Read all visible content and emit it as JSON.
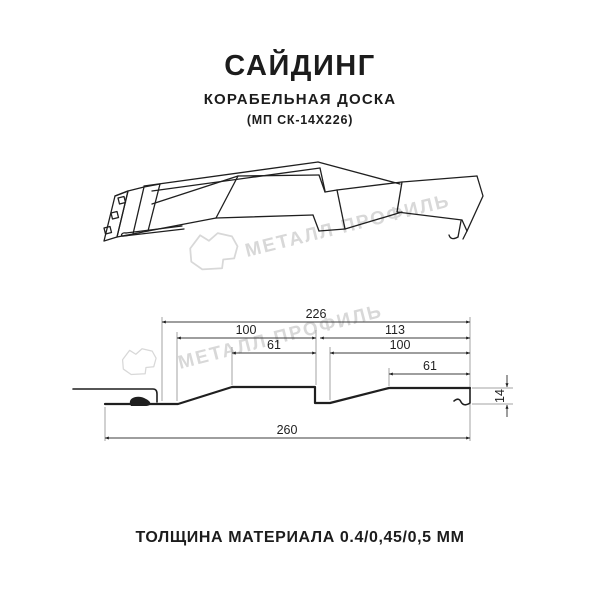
{
  "header": {
    "title": "САЙДИНГ",
    "subtitle": "КОРАБЕЛЬНАЯ ДОСКА",
    "model": "(МП СК-14Х226)"
  },
  "watermark": {
    "text": "МЕТАЛЛ ПРОФИЛЬ"
  },
  "drawing": {
    "module_width": "226",
    "panel1_width": "100",
    "panel1_flat": "61",
    "panel2_module": "113",
    "panel2_width": "100",
    "panel2_flat": "61",
    "total_width": "260",
    "profile_height": "14"
  },
  "footer": {
    "thickness_label": "ТОЛЩИНА МАТЕРИАЛА 0.4/0,45/0,5 ММ"
  },
  "colors": {
    "ink": "#1f1f1f",
    "dimension_line": "#3c3c3c",
    "extension_line": "#a3a3a3",
    "watermark": "#d8d8d8",
    "background": "#ffffff"
  }
}
